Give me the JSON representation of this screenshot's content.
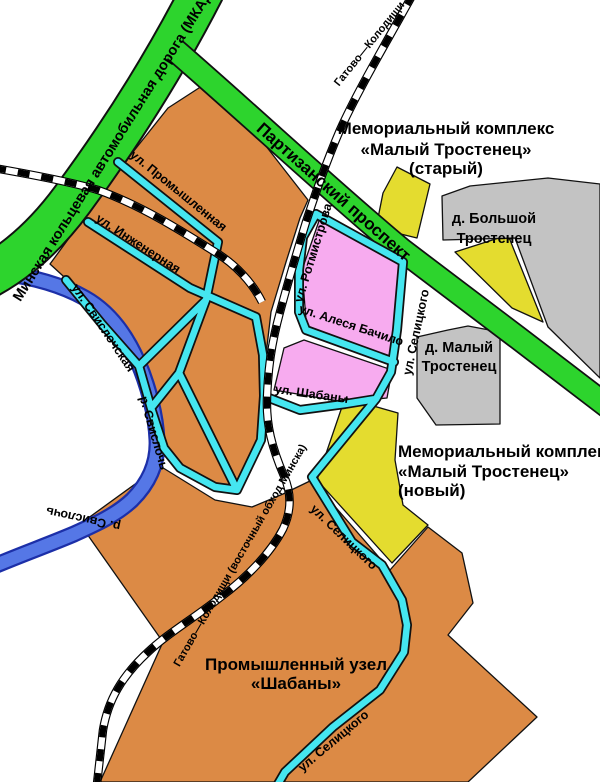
{
  "colors": {
    "background": "#ffffff",
    "motorway_green": "#2dd42d",
    "road_casing": "#111111",
    "street_cyan": "#45e6f0",
    "river_blue": "#5577e6",
    "river_casing": "#1c2fa8",
    "railway_black": "#000000",
    "railway_white": "#ffffff",
    "industrial_orange": "#dc8a45",
    "residential_pink": "#f7abef",
    "memorial_yellow": "#e4dc2f",
    "village_grey": "#c3c3c3",
    "label_black": "#000000"
  },
  "labels": {
    "roads": {
      "mkad": "Минская кольцевая автомобильная дорога (МКАД)",
      "partizansky": "Партизанский проспект"
    },
    "railways": {
      "top": "Гатово—Колодищи",
      "bypass": "Гатово—Колодищи (восточный обход Минска)"
    },
    "river": {
      "name": "р. Свислочь"
    },
    "streets": {
      "promyshlennaya": "ул. Промышленная",
      "inzhenernaya": "ул. Инженерная",
      "svislochskaya": "ул. Свислочская",
      "rotmistrova": "ул. Ротмистрова",
      "alesya_bachilo": "ул. Алеся Бачило",
      "shabany": "ул. Шабаны",
      "selitskogo": "ул. Селицкого"
    },
    "areas": {
      "memorial_old": {
        "line1": "Мемориальный комплекс",
        "line2": "«Малый Тростенец»",
        "line3": "(старый)"
      },
      "memorial_new": {
        "line1": "Мемориальный комплекс",
        "line2": "«Малый Тростенец»",
        "line3": "(новый)"
      },
      "village_bolshoy": {
        "line1": "д. Большой",
        "line2": "Тростенец"
      },
      "village_maly": {
        "line1": "д. Малый",
        "line2": "Тростенец"
      },
      "industrial_hub": {
        "line1": "Промышленный узел",
        "line2": "«Шабаны»"
      }
    }
  }
}
